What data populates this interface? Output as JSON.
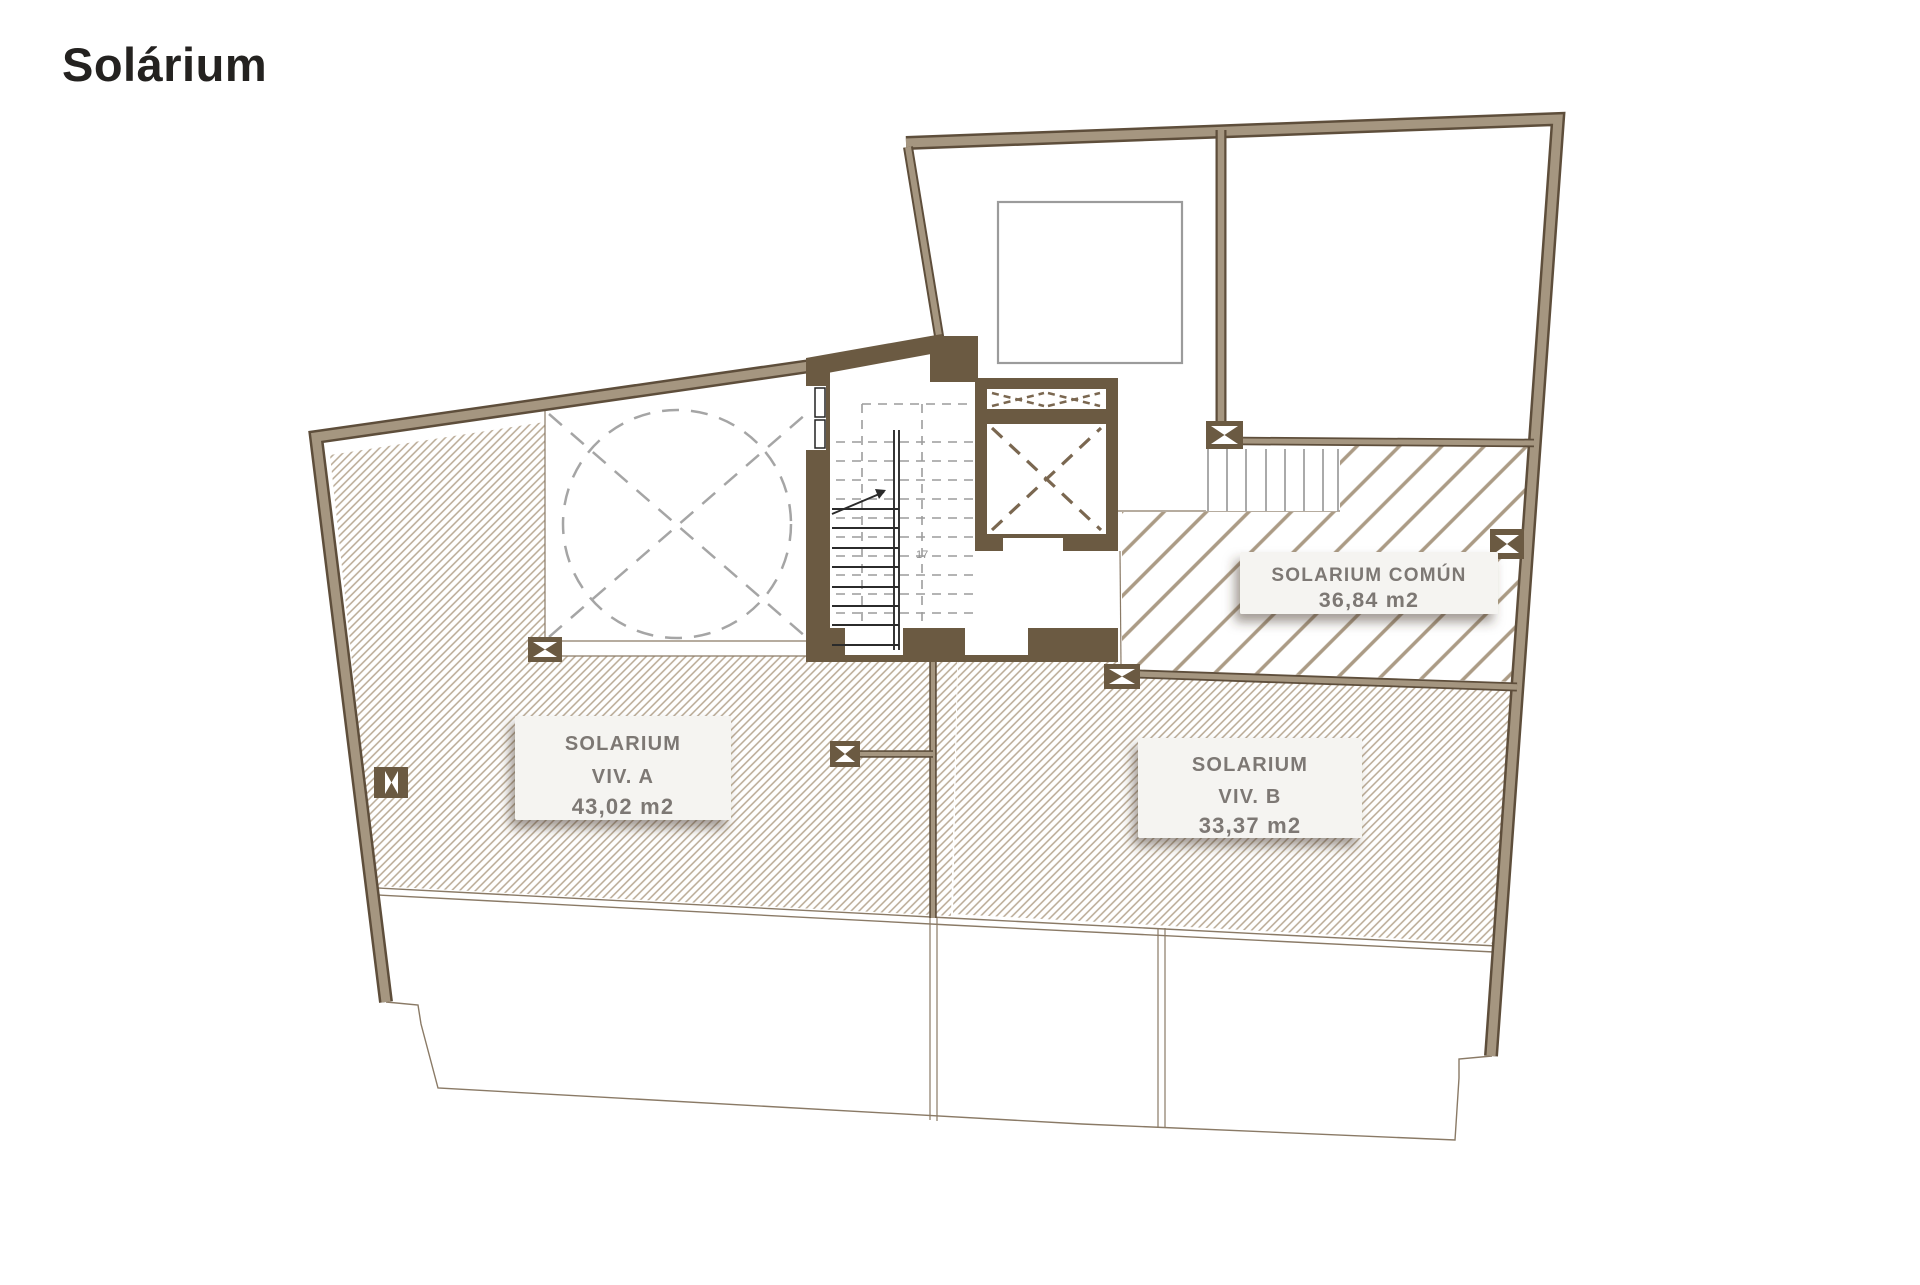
{
  "title": "Solárium",
  "plan": {
    "areas": {
      "comun": {
        "name": "SOLARIUM COMÚN",
        "size": "36,84 m2"
      },
      "viv_a": {
        "name": "SOLARIUM",
        "unit": "VIV. A",
        "size": "43,02 m2"
      },
      "viv_b": {
        "name": "SOLARIUM",
        "unit": "VIV. B",
        "size": "33,37 m2"
      }
    },
    "stair_riser_count": "17",
    "colors": {
      "wall": "#a59680",
      "wall_dark": "#6b5a42",
      "wall_edge": "#5e4e3b",
      "hatch_fine": "#b9a994",
      "hatch_coarse": "#ab9b85",
      "label_text": "#7d7874"
    }
  }
}
